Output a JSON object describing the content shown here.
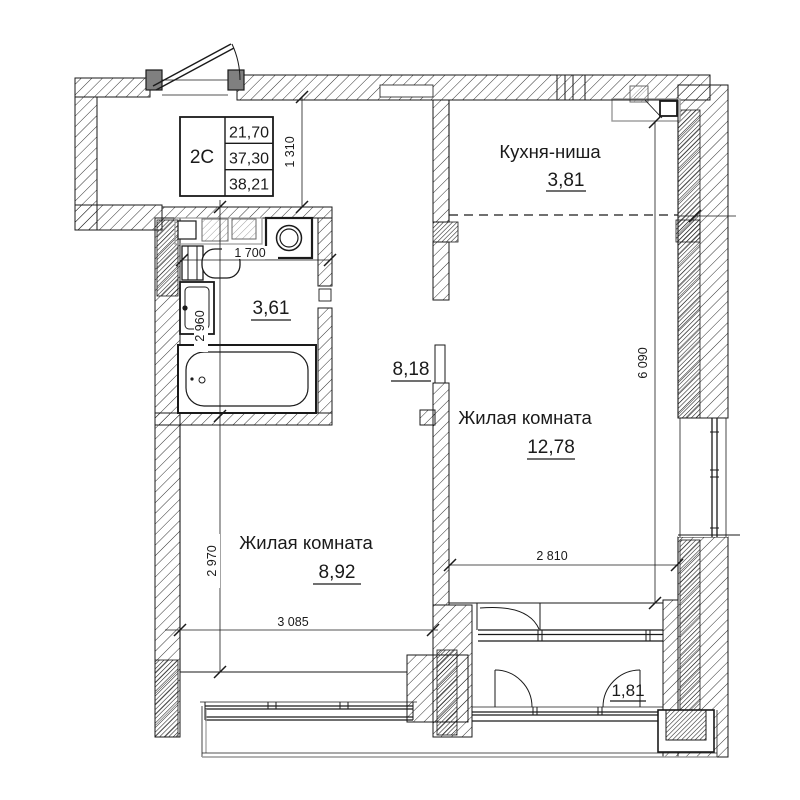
{
  "plan": {
    "unit_table": {
      "type_label": "2С",
      "rows": [
        "21,70",
        "37,30",
        "38,21"
      ]
    },
    "rooms": {
      "kitchen": {
        "name": "Кухня-ниша",
        "area": "3,81"
      },
      "living_right": {
        "name": "Жилая комната",
        "area": "12,78"
      },
      "living_left": {
        "name": "Жилая комната",
        "area": "8,92"
      },
      "bathroom": {
        "area": "3,61"
      },
      "hall": {
        "area": "8,18"
      },
      "balcony": {
        "area": "1,81"
      }
    },
    "dimensions": {
      "entry_depth": "1 310",
      "bath_width": "1 700",
      "bath_depth": "2 960",
      "living_left_depth": "2 970",
      "living_left_width": "3 085",
      "living_right_width": "2 810",
      "right_side_depth": "6 090"
    },
    "colors": {
      "ink": "#1a1a1a",
      "door_post_gray": "#808080",
      "light_gray": "#999999"
    }
  }
}
